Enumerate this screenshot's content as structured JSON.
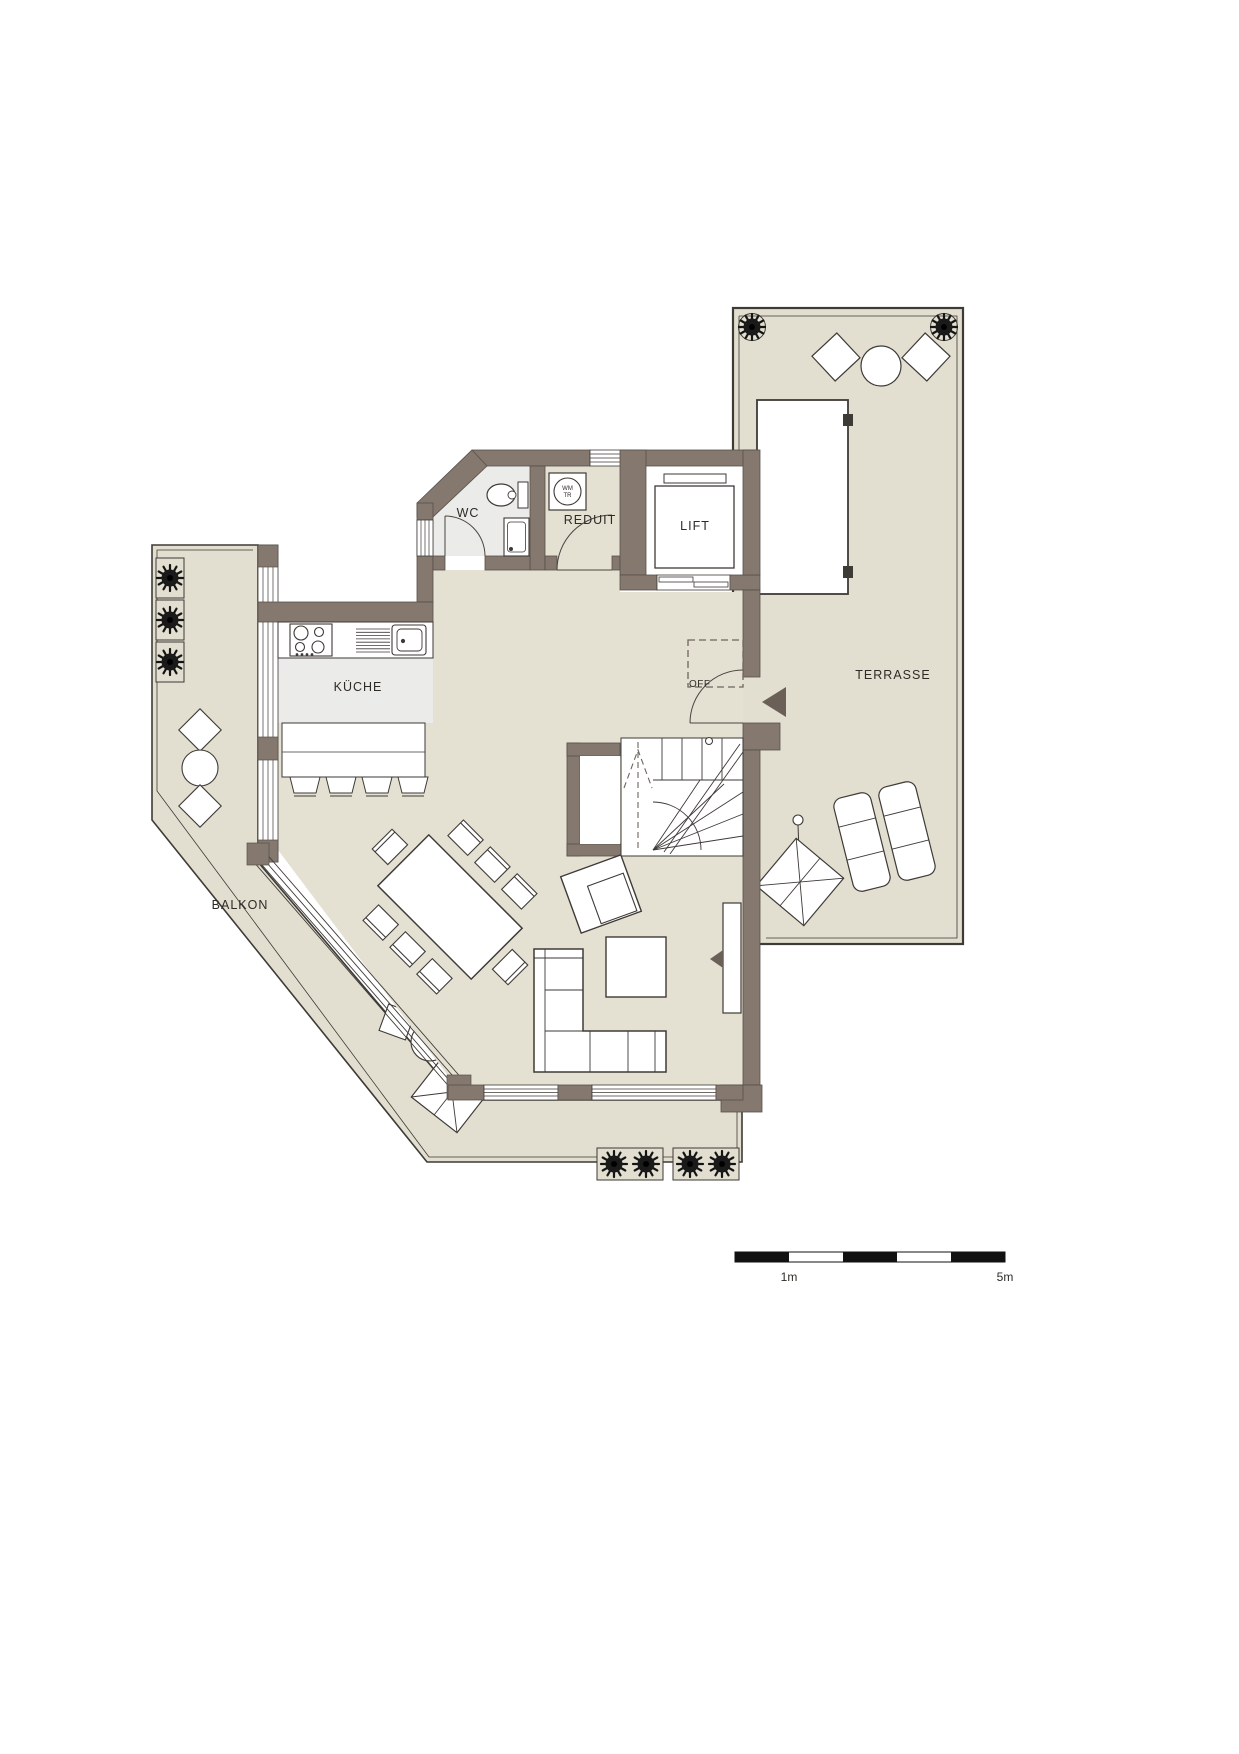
{
  "rooms": {
    "wc": "WC",
    "reduit": "REDUIT",
    "lift": "LIFT",
    "kitchen": "KÜCHE",
    "terrace": "TERRASSE",
    "balcony": "BALKON"
  },
  "annotations": {
    "opening": "OFF",
    "washer_line1": "WM",
    "washer_line2": "TR"
  },
  "scale_bar": {
    "one_meter": "1m",
    "five_meters": "5m"
  },
  "colors": {
    "wall": "#84786F",
    "indoor_floor": "#E4E1D3",
    "outdoor_floor": "#E2DFD0",
    "kitchen_floor": "#EBEBE9",
    "wc_floor": "#EBEBE9",
    "line": "#3E3A36",
    "dashed_line": "#6E655D",
    "text": "#2E2A26",
    "plant": "#141414",
    "entrance_arrow": "#6B6057"
  }
}
